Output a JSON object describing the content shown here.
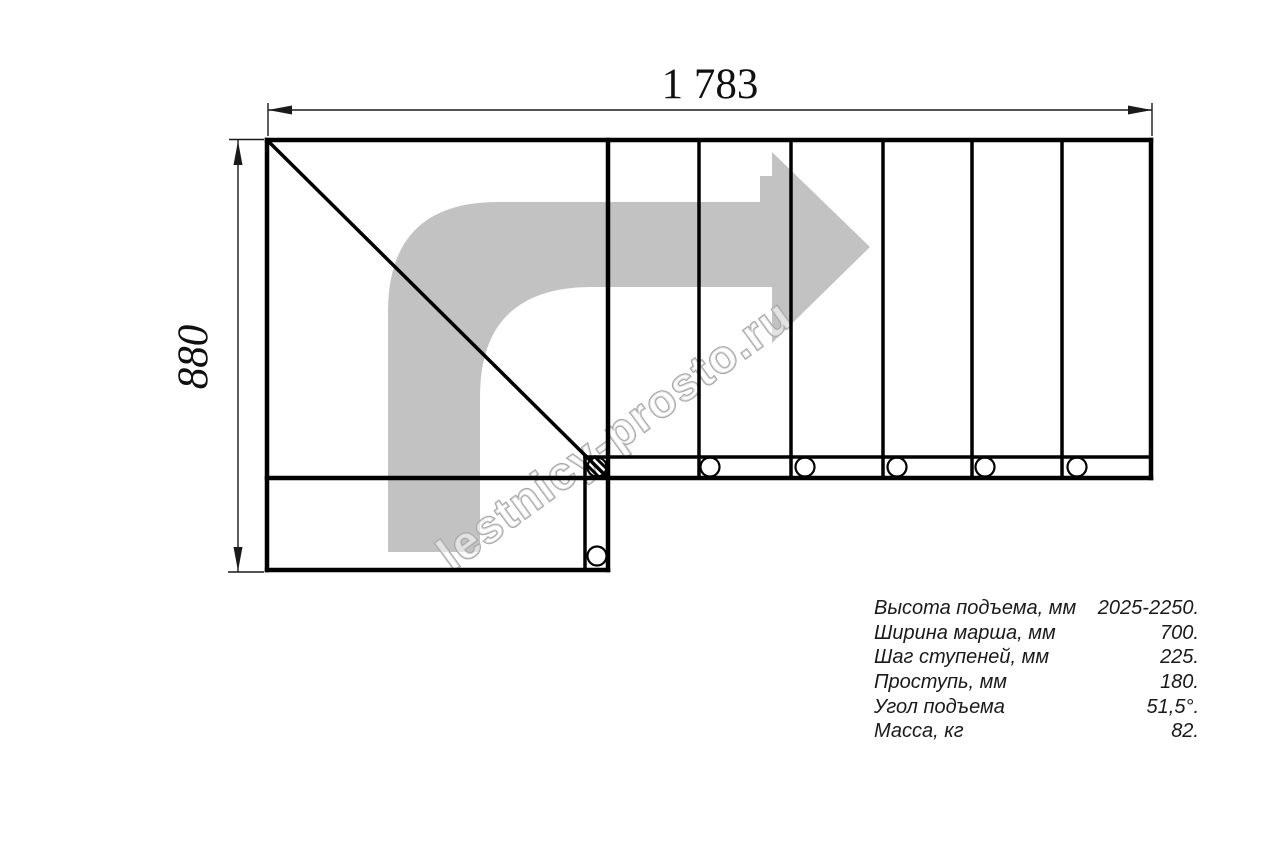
{
  "drawing": {
    "title": "staircase-plan-top-view",
    "dimensions": {
      "width_label": "1 783",
      "height_label": "880"
    },
    "watermark": {
      "text": "lestnicy-prosto.ru"
    }
  },
  "specs": {
    "rows": [
      {
        "label": "Высота подъема, мм",
        "value": "2025-2250."
      },
      {
        "label": "Ширина марша, мм",
        "value": "700."
      },
      {
        "label": "Шаг ступеней, мм",
        "value": "225."
      },
      {
        "label": "Проступь, мм",
        "value": "180."
      },
      {
        "label": "Угол подъема",
        "value": "51,5°."
      },
      {
        "label": "Масса, кг",
        "value": "82."
      }
    ]
  },
  "colors": {
    "background": "#ffffff",
    "line": "#000000",
    "arrow_gray": "#c2c2c2",
    "watermark_gray": "#a5a5a5",
    "text": "#1a1a1a"
  }
}
